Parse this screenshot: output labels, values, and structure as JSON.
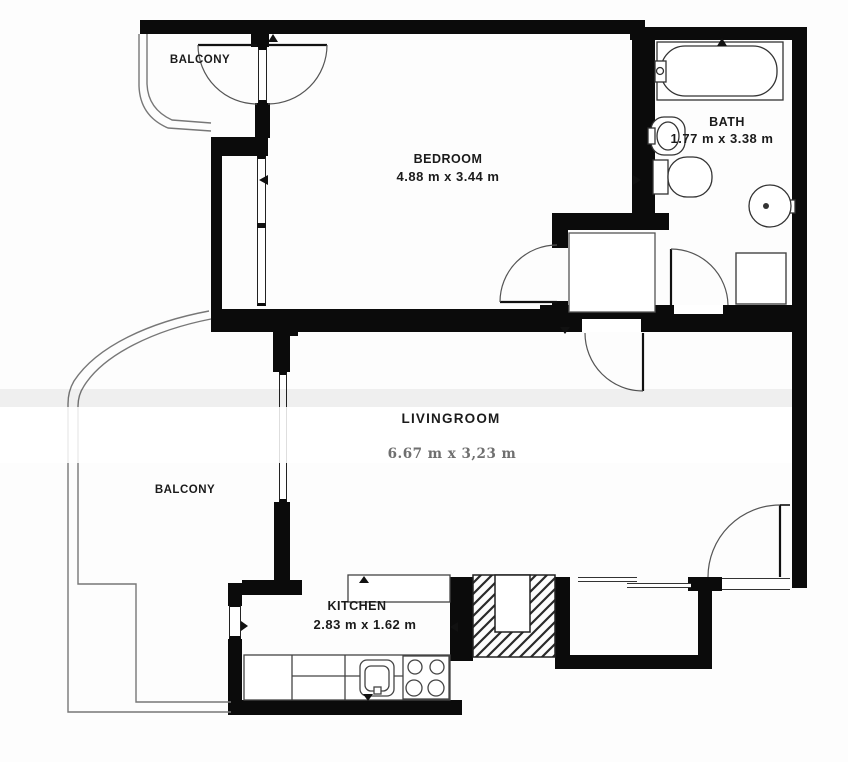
{
  "floorplan": {
    "rooms": [
      {
        "name": "BALCONY",
        "dimensions": ""
      },
      {
        "name": "BEDROOM",
        "dimensions": "4.88 m x 3.44 m"
      },
      {
        "name": "BATH",
        "dimensions": "1.77 m x 3.38 m"
      },
      {
        "name": "LIVINGROOM",
        "dimensions": "6.67 m x 3,23 m"
      },
      {
        "name": "BALCONY",
        "dimensions": ""
      },
      {
        "name": "KITCHEN",
        "dimensions": "2.83 m x 1.62 m"
      }
    ],
    "colors": {
      "wall": "#0b0b0b",
      "thin_line": "#555555",
      "dimension_text": "#6f6f6f",
      "label_text": "#1b1b1b",
      "background": "#fdfdfd"
    }
  }
}
